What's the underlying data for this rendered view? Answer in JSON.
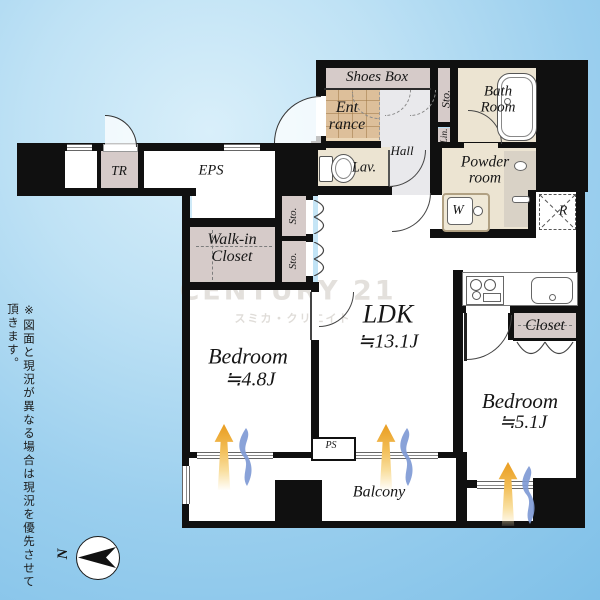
{
  "watermark": {
    "brand": "CENTURY 21",
    "subbrand": "スミカ・クリエイト"
  },
  "note": "※図面と現況が異なる場合は現況を優先させて頂きます。",
  "compass": {
    "north_label": "N"
  },
  "rooms": {
    "shoes_box": "Shoes Box",
    "entrance_l1": "Ent",
    "entrance_l2": "rance",
    "hall": "Hall",
    "sto_strip": "Sto.",
    "lin_strip": "Lin.",
    "bath_l1": "Bath",
    "bath_l2": "Room",
    "powder_l1": "Powder",
    "powder_l2": "room",
    "washer": "W",
    "fridge": "R",
    "lav": "Lav.",
    "tr": "TR",
    "eps": "EPS",
    "wic_l1": "Walk-in",
    "wic_l2": "Closet",
    "sto1": "Sto.",
    "sto2": "Sto.",
    "ldk": "LDK",
    "ldk_size": "≒13.1J",
    "bedroom1": "Bedroom",
    "bedroom1_size": "≒4.8J",
    "bedroom2": "Bedroom",
    "bedroom2_size": "≒5.1J",
    "closet": "Closet",
    "ps": "PS",
    "balcony": "Balcony"
  },
  "colors": {
    "wall": "#101010",
    "storage_mauve": "#d6cbc9",
    "wet_cream": "#ece4d2",
    "entrance_tan": "#ddbf9a",
    "hall_gray": "#e9e9ec",
    "sun_arrow": "#eeab2e",
    "wind_wave": "#7f9ad5",
    "background_blue": "#9fd1ef"
  }
}
